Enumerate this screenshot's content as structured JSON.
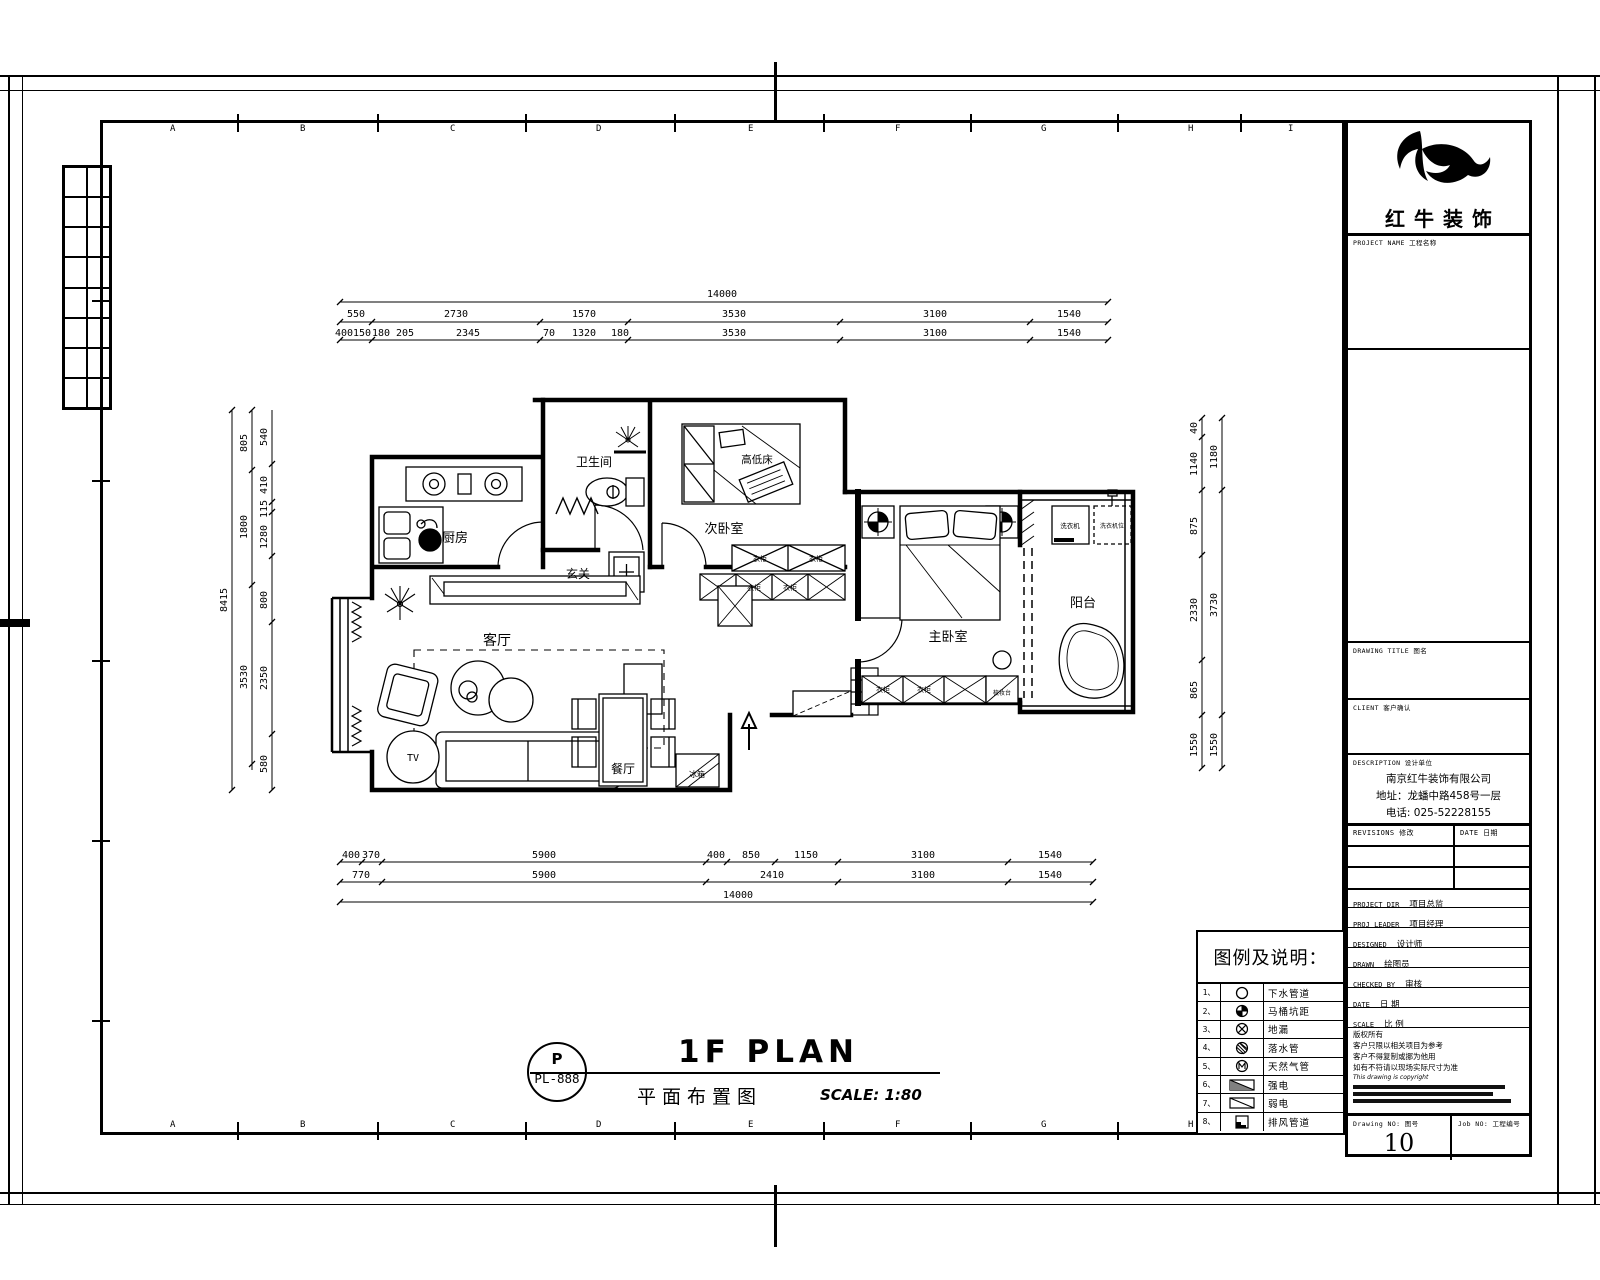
{
  "sheet": {
    "grid_letters": [
      "A",
      "B",
      "C",
      "D",
      "E",
      "F",
      "G",
      "H",
      "I"
    ]
  },
  "logo": {
    "name": "红牛装饰"
  },
  "title_block": {
    "project_name_label": "PROJECT NAME  工程名称",
    "drawing_title_label": "DRAWING TITLE  图名",
    "client_label": "CLIENT  客户确认",
    "description_label": "DESCRIPTION  设计单位",
    "company_lines": [
      "南京红牛装饰有限公司",
      "地址：龙蟠中路458号一层",
      "电话: 025-52228155"
    ],
    "revisions_label": "REVISIONS  修改",
    "rev_date_label": "DATE 日期",
    "info_rows": [
      {
        "en": "PROJECT DIR",
        "cn": "项目总监"
      },
      {
        "en": "PROJ LEADER",
        "cn": "项目经理"
      },
      {
        "en": "DESIGNED",
        "cn": "设计师"
      },
      {
        "en": "DRAWN",
        "cn": "绘图员"
      },
      {
        "en": "CHECKED BY",
        "cn": "审核"
      },
      {
        "en": "DATE",
        "cn": "日 期"
      },
      {
        "en": "SCALE",
        "cn": "比 例"
      }
    ],
    "copyright_lines": [
      "版权所有",
      "客户只限以相关项目为参考",
      "客户不得复制或挪为他用",
      "如有不符请以现场实际尺寸为准"
    ],
    "copyright_en": "This drawing is copyright",
    "drawing_no_label": "Drawing NO:  图号",
    "drawing_no": "10",
    "job_no_label": "Job NO:  工程编号"
  },
  "legend": {
    "title": "图例及说明：",
    "rows": [
      {
        "no": "1、",
        "label": "下水管道"
      },
      {
        "no": "2、",
        "label": "马桶坑距"
      },
      {
        "no": "3、",
        "label": "地漏"
      },
      {
        "no": "4、",
        "label": "落水管"
      },
      {
        "no": "5、",
        "label": "天然气管"
      },
      {
        "no": "6、",
        "label": "强电"
      },
      {
        "no": "7、",
        "label": "弱电"
      },
      {
        "no": "8、",
        "label": "排风管道"
      }
    ]
  },
  "plan_title": {
    "bubble_top": "P",
    "bubble_bottom": "PL-888",
    "title": "1F PLAN",
    "subtitle": "平面布置图",
    "scale": "SCALE: 1:80"
  },
  "plan": {
    "labels": {
      "kitchen": "厨房",
      "bath": "卫生间",
      "foyer": "玄关",
      "bedroom2": "次卧室",
      "bunk_bed": "高低床",
      "master": "主卧室",
      "balcony": "阳台",
      "living": "客厅",
      "dining": "餐厅",
      "tv": "TV",
      "fridge": "冰箱",
      "washer": "洗衣机",
      "washer_spot": "洗衣机位",
      "wardrobe": "衣柜",
      "dresser": "梳妆台"
    }
  },
  "dims": {
    "top_overall": "14000",
    "top_row2": [
      "550",
      "2730",
      "1570",
      "3530",
      "3100",
      "1540"
    ],
    "top_row3": [
      "400",
      "150",
      "180",
      "205",
      "2345",
      "70",
      "1320",
      "180",
      "3530",
      "3100",
      "1540"
    ],
    "bottom_row1": [
      "400",
      "370",
      "5900",
      "400",
      "850",
      "1150",
      "3100",
      "1540"
    ],
    "bottom_row2": [
      "770",
      "5900",
      "2410",
      "3100",
      "1540"
    ],
    "bottom_overall": "14000",
    "left_overall": "8415",
    "left_mid": [
      "805",
      "1800",
      "3530"
    ],
    "left_inner": [
      "540",
      "410",
      "115",
      "1280",
      "800",
      "2350",
      "580"
    ],
    "right_inner": [
      "40",
      "1140",
      "875",
      "2330",
      "865",
      "1550"
    ],
    "right_outer": [
      "1180",
      "3730",
      "1550"
    ]
  }
}
